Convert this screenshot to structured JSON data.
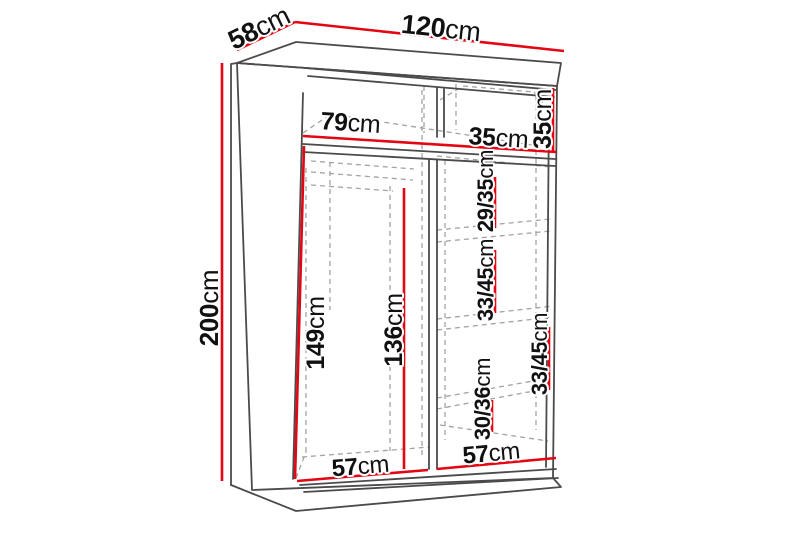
{
  "colors": {
    "dimension_line": "#e30613",
    "outline": "#4b4b4b",
    "hidden_line": "#a3a3a3",
    "label_text": "#111111",
    "background": "#ffffff"
  },
  "labels": {
    "depth": {
      "value": "58",
      "unit": "cm"
    },
    "width": {
      "value": "120",
      "unit": "cm"
    },
    "height": {
      "value": "200",
      "unit": "cm"
    },
    "interior_left_width": {
      "value": "79",
      "unit": "cm"
    },
    "interior_right_width": {
      "value": "35",
      "unit": "cm"
    },
    "top_right_section_height": {
      "value": "35",
      "unit": "cm"
    },
    "right_section_1_height": {
      "value": "29/35",
      "unit": "cm"
    },
    "right_section_2_height": {
      "value": "33/45",
      "unit": "cm"
    },
    "right_section_3_height": {
      "value": "33/45",
      "unit": "cm"
    },
    "right_section_4_height": {
      "value": "30/36",
      "unit": "cm"
    },
    "left_interior_height": {
      "value": "149",
      "unit": "cm"
    },
    "rod_clearance_height": {
      "value": "136",
      "unit": "cm"
    },
    "left_floor_width": {
      "value": "57",
      "unit": "cm"
    },
    "right_floor_width": {
      "value": "57",
      "unit": "cm"
    }
  }
}
